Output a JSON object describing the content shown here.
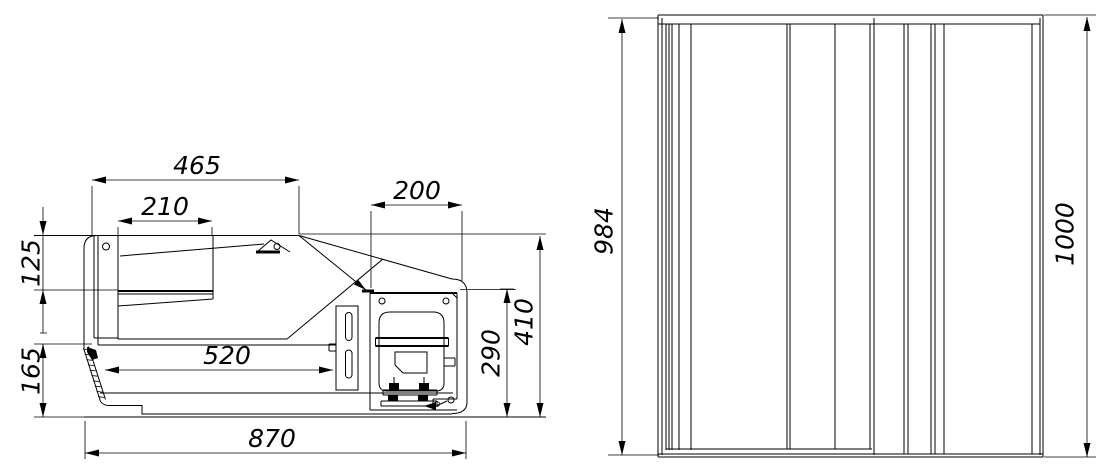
{
  "drawing": {
    "kind": "technical-drawing-two-views",
    "colors": {
      "line": "#000000",
      "background": "#ffffff"
    }
  },
  "side_view": {
    "dims": {
      "top_width": "465",
      "lamp_box_width": "210",
      "machine_width": "200",
      "canopy_height": "125",
      "base_height": "165",
      "inner_depth": "520",
      "machine_height": "290",
      "front_height": "410",
      "total_depth": "870"
    }
  },
  "front_view": {
    "dims": {
      "inner_height": "984",
      "total_height": "1000"
    }
  }
}
